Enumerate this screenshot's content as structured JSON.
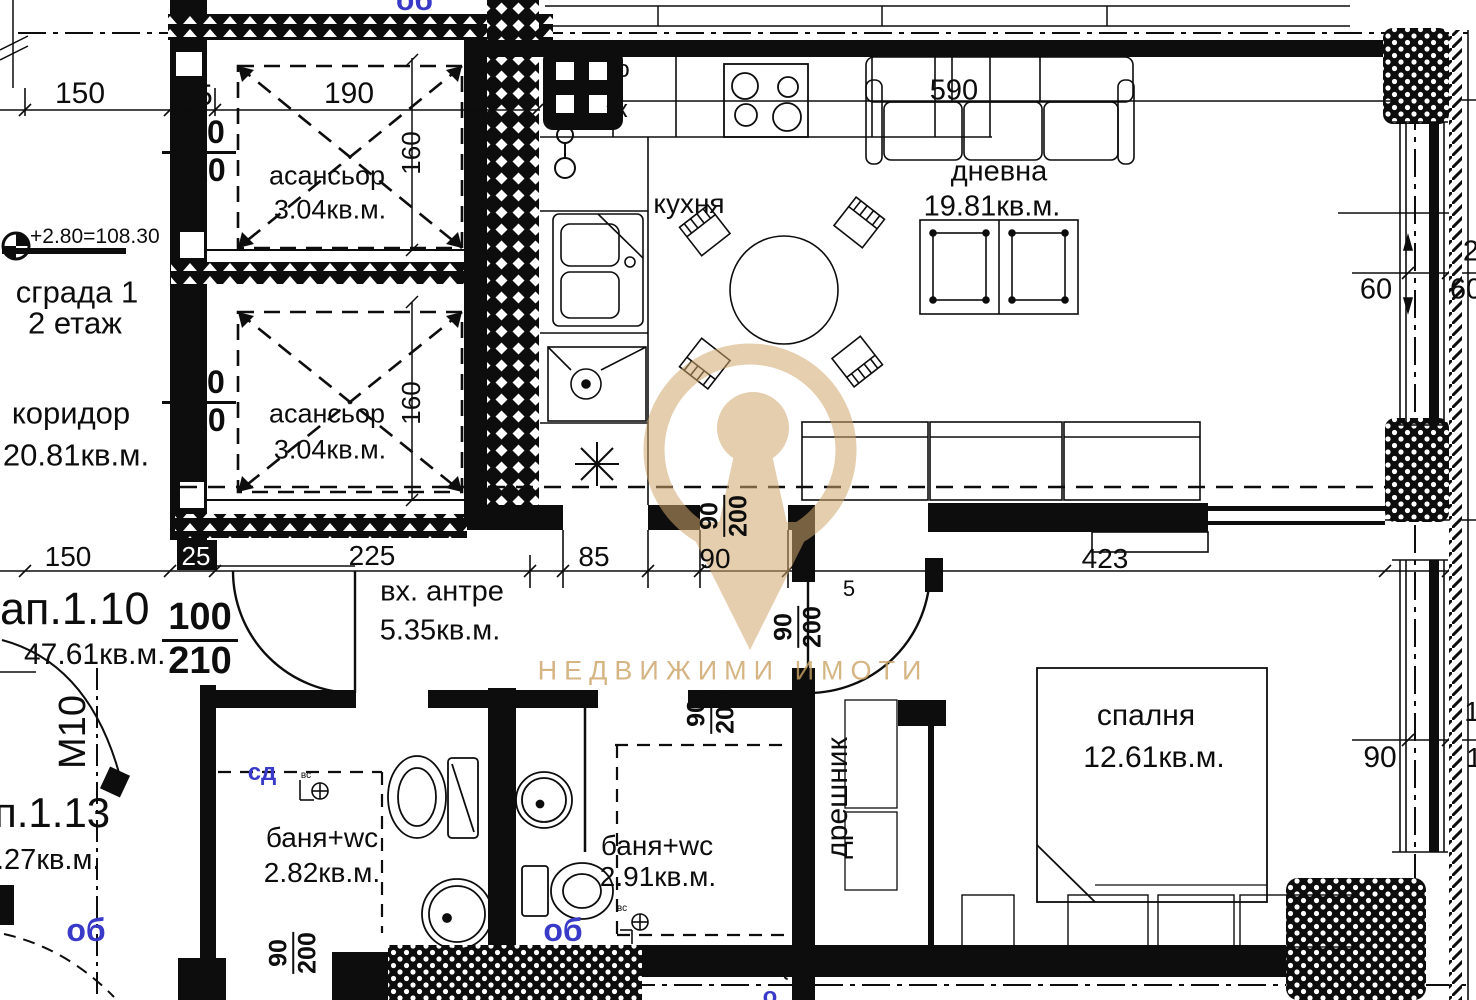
{
  "watermark": {
    "text": "НЕДВИЖИМИ ИМОТИ",
    "color": "#cda76b"
  },
  "site": {
    "level_mark": "+2.80=108.30",
    "building": "сграда 1",
    "floor": "2 етаж"
  },
  "corridor": {
    "name": "коридор",
    "area": "20.81кв.м."
  },
  "elevators": {
    "name": "асансьор",
    "area": "3.04кв.м."
  },
  "apartment_1_10": {
    "id": "ап.1.10",
    "total_area": "47.61кв.м.",
    "rooms": {
      "entry": {
        "name": "вх. антре",
        "area": "5.35кв.м."
      },
      "kitchen": {
        "name": "кухня"
      },
      "living": {
        "name": "дневна",
        "area": "19.81кв.м."
      },
      "bath": {
        "name": "баня+wc",
        "area": "2.91кв.м."
      },
      "closet": {
        "name": "дрешник"
      },
      "bedroom": {
        "name": "спалня",
        "area": "12.61кв.м."
      }
    }
  },
  "apartment_1_13": {
    "id": "п.1.13",
    "total_area": ".27кв.м.",
    "bath": {
      "name": "баня+wc",
      "area": "2.82кв.м."
    },
    "column_mark": "М10"
  },
  "doors": {
    "lift_door": {
      "w": "110",
      "h": "210"
    },
    "entry_door": {
      "w": "100",
      "h": "210"
    },
    "interior_door": {
      "w": "90",
      "h": "200"
    }
  },
  "dimensions": {
    "top": {
      "d150": "150",
      "d25": "25",
      "d190": "190",
      "d590": "590"
    },
    "middle": {
      "d150": "150",
      "d25": "25",
      "d225": "225",
      "d85": "85",
      "d90": "90",
      "d423": "423"
    },
    "right": {
      "d60a": "60",
      "d60b": "60",
      "d2": "2",
      "d90": "90",
      "d1a": "1",
      "d1b": "1"
    },
    "shaft_width": "160",
    "d5": "5",
    "wall_25": "25"
  },
  "annotations": {
    "letter_o": "о",
    "letter_k": "к",
    "vs": "вс",
    "plumb_top": "об",
    "plumb_bath1": "сд",
    "plumb_bath2": "об",
    "plumb_113": "об",
    "plumb_bottom": "о"
  },
  "colors": {
    "ink": "#0d0d0d",
    "plumbing_blue": "#3a3ac8",
    "watermark_gold": "#cda76b"
  }
}
